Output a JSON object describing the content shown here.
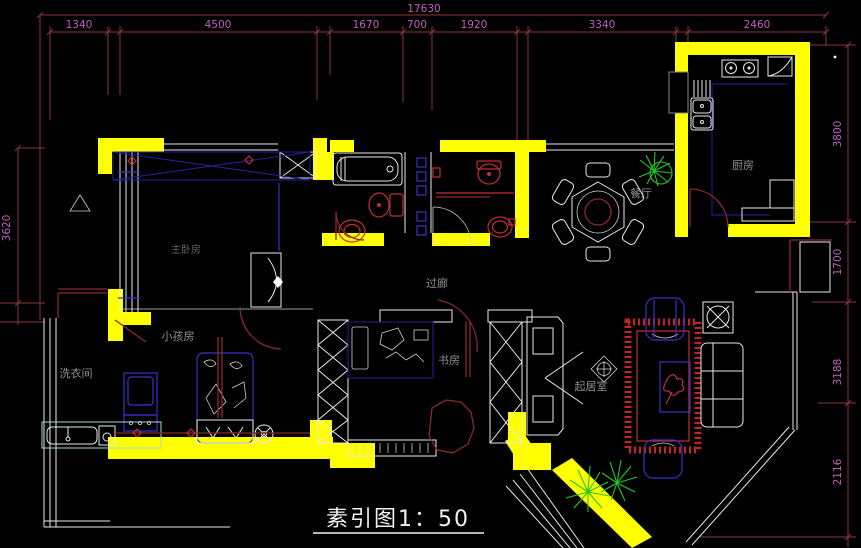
{
  "canvas": {
    "width": 861,
    "height": 548,
    "background": "#000000"
  },
  "title_block": {
    "text": "素引图1：50"
  },
  "rooms": {
    "master": "主卧房",
    "kids": "小孩房",
    "laundry": "洗衣间",
    "corridor": "过廊",
    "study": "书房",
    "living": "起居室",
    "dining": "餐厅",
    "kitchen": "厨房"
  },
  "dimensions": {
    "top": {
      "overall": "17630",
      "segments": [
        "1340",
        "4500",
        "1670",
        "700",
        "1920",
        "3340",
        "2460"
      ]
    },
    "right": {
      "segments": [
        "3800",
        "1700",
        "3188",
        "2116"
      ]
    },
    "left": {
      "segments": [
        "3620"
      ]
    }
  },
  "colors": {
    "wall": "#ffff00",
    "dimension_line": "#8a3636",
    "dimension_text": "#c05fc0",
    "room_label": "#8f8f8f",
    "furniture_white": "#e8e8e8",
    "furniture_blue": "#3434c8",
    "furniture_red": "#c03030",
    "door_red": "#8b2a2a",
    "counter_cyan": "#9fd8d8",
    "plant_green": "#22c822",
    "title_white": "#f2f2f2"
  }
}
